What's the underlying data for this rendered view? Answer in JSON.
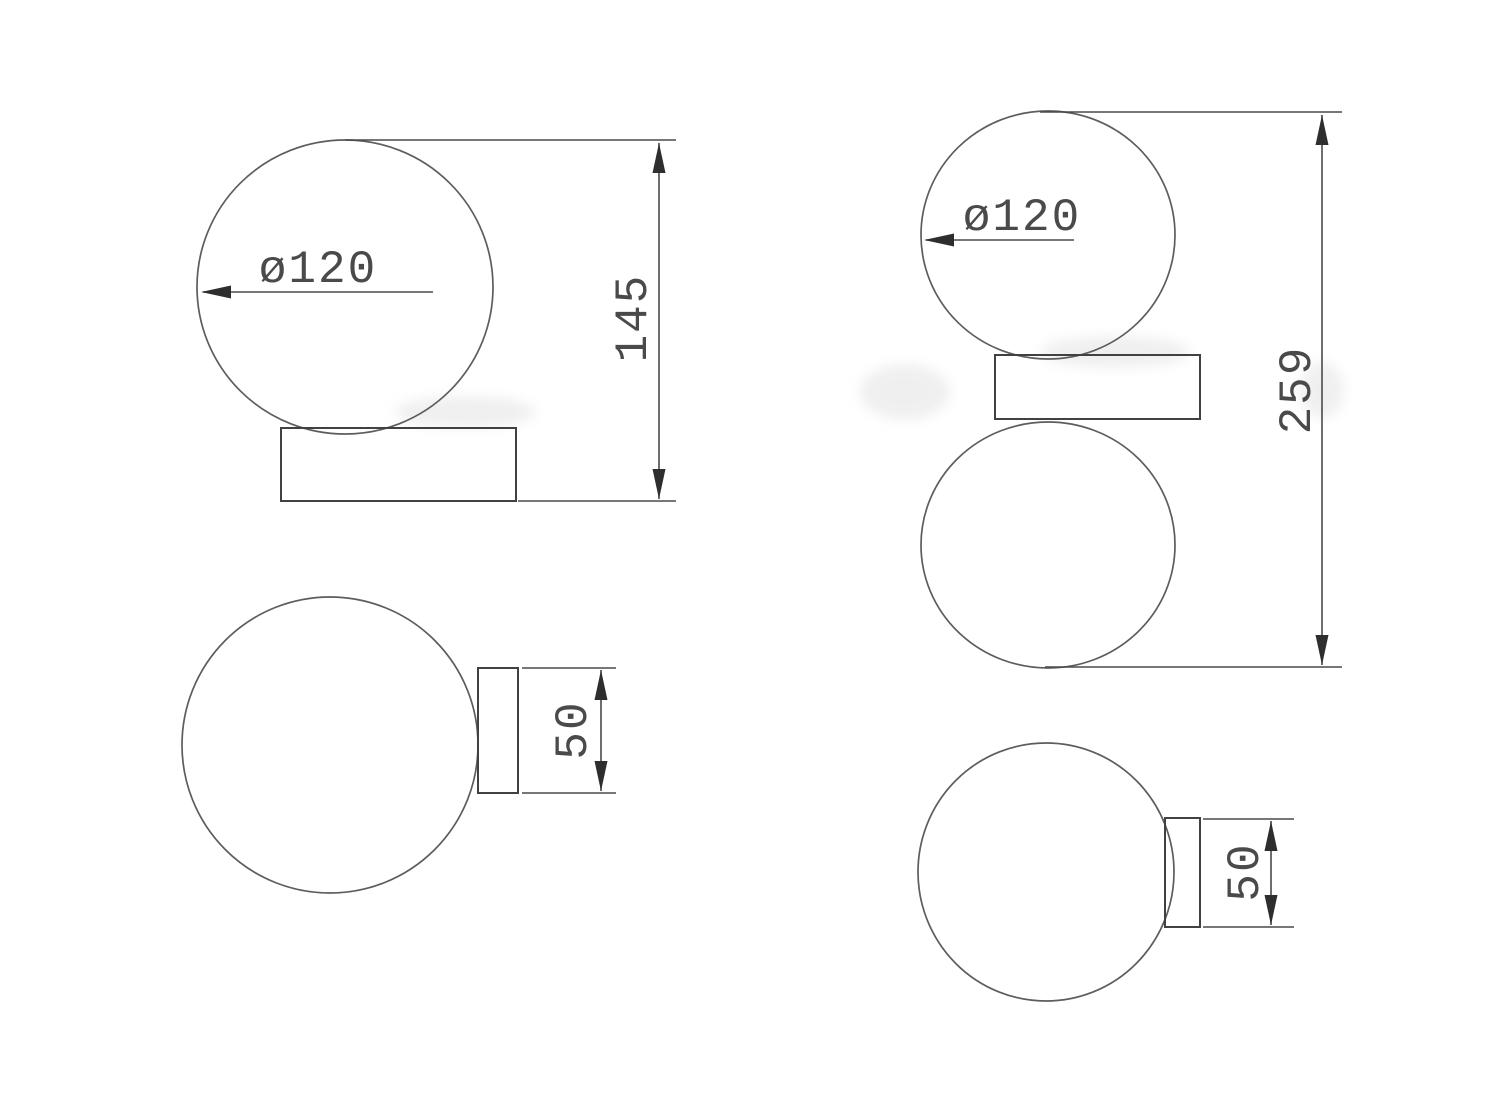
{
  "drawing": {
    "type": "technical-dimension-drawing",
    "figures": [
      {
        "name": "single-globe-side-view",
        "description": "globe lamp on rectangular base, front elevation",
        "labels": {
          "diameter": "ø120",
          "overall_height": "145"
        }
      },
      {
        "name": "single-globe-top-view",
        "description": "globe lamp plan view with wall box",
        "labels": {
          "base_depth": "50"
        }
      },
      {
        "name": "double-globe-side-view",
        "description": "two globes with center bracket, front elevation",
        "labels": {
          "diameter": "ø120",
          "overall_height": "259"
        }
      },
      {
        "name": "double-globe-top-view",
        "description": "double globe plan view with wall box",
        "labels": {
          "base_depth": "50"
        }
      }
    ],
    "colors": {
      "background": "#ffffff",
      "outline_line": "#5d5d5d",
      "object_line": "#414141",
      "dimension_line": "#4a4a4a",
      "arrow_fill": "#2e2e2e",
      "text": "#4a4a4a"
    }
  }
}
